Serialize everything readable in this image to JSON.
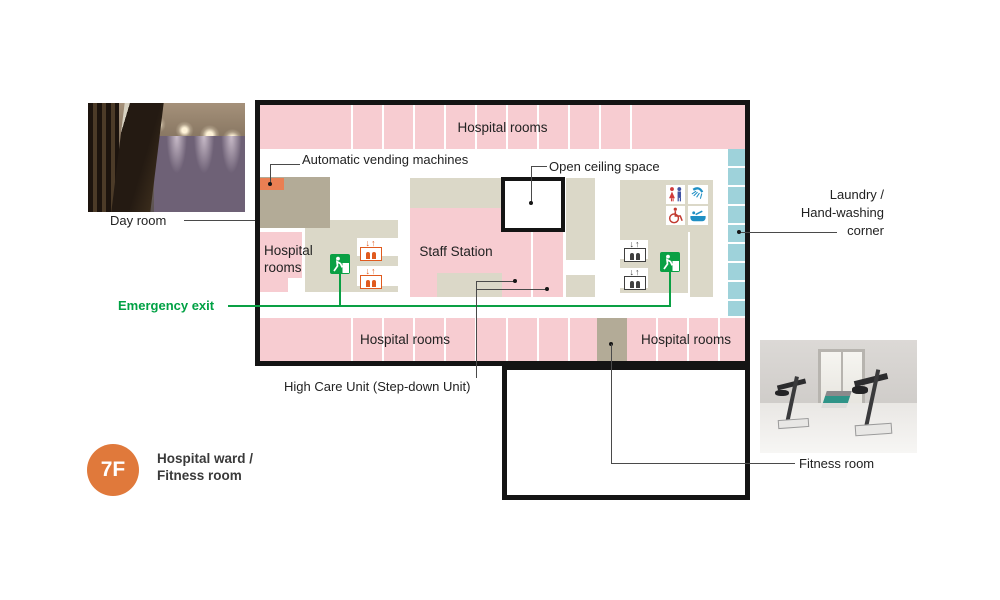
{
  "palette": {
    "room_pink": "#f7ccd1",
    "zone_beige": "#dbd8c8",
    "zone_dark_beige": "#b3ab97",
    "laundry_teal": "#9ed2da",
    "vending_orange": "#ea7f53",
    "elevator_orange": "#e05a1e",
    "elevator_gray": "#3f3f3f",
    "exit_green": "#0aa044",
    "badge_orange": "#e0793b",
    "plan_border": "#141414"
  },
  "badge": {
    "floor": "7F",
    "title_line1": "Hospital ward  /",
    "title_line2": "Fitness room"
  },
  "rooms": {
    "top": "Hospital rooms",
    "left_line1": "Hospital",
    "left_line2": "rooms",
    "staff": "Staff Station",
    "bottom_left": "Hospital rooms",
    "bottom_right": "Hospital rooms"
  },
  "callouts": {
    "vending": "Automatic vending machines",
    "open_ceiling": "Open ceiling space",
    "day_room": "Day room",
    "laundry_1": "Laundry /",
    "laundry_2": "Hand-washing",
    "laundry_3": "corner",
    "emergency_exit": "Emergency exit",
    "high_care": "High Care Unit (Step-down Unit)",
    "fitness": "Fitness room"
  },
  "icons": {
    "elevator_arrows": "↓↑",
    "names": [
      "emergency-exit-icon",
      "elevator-icon-orange",
      "elevator-icon-gray",
      "toilet-icon",
      "shower-icon",
      "accessible-icon",
      "bath-icon",
      "vending-machine-block",
      "laundry-cells",
      "open-ceiling-space"
    ]
  }
}
